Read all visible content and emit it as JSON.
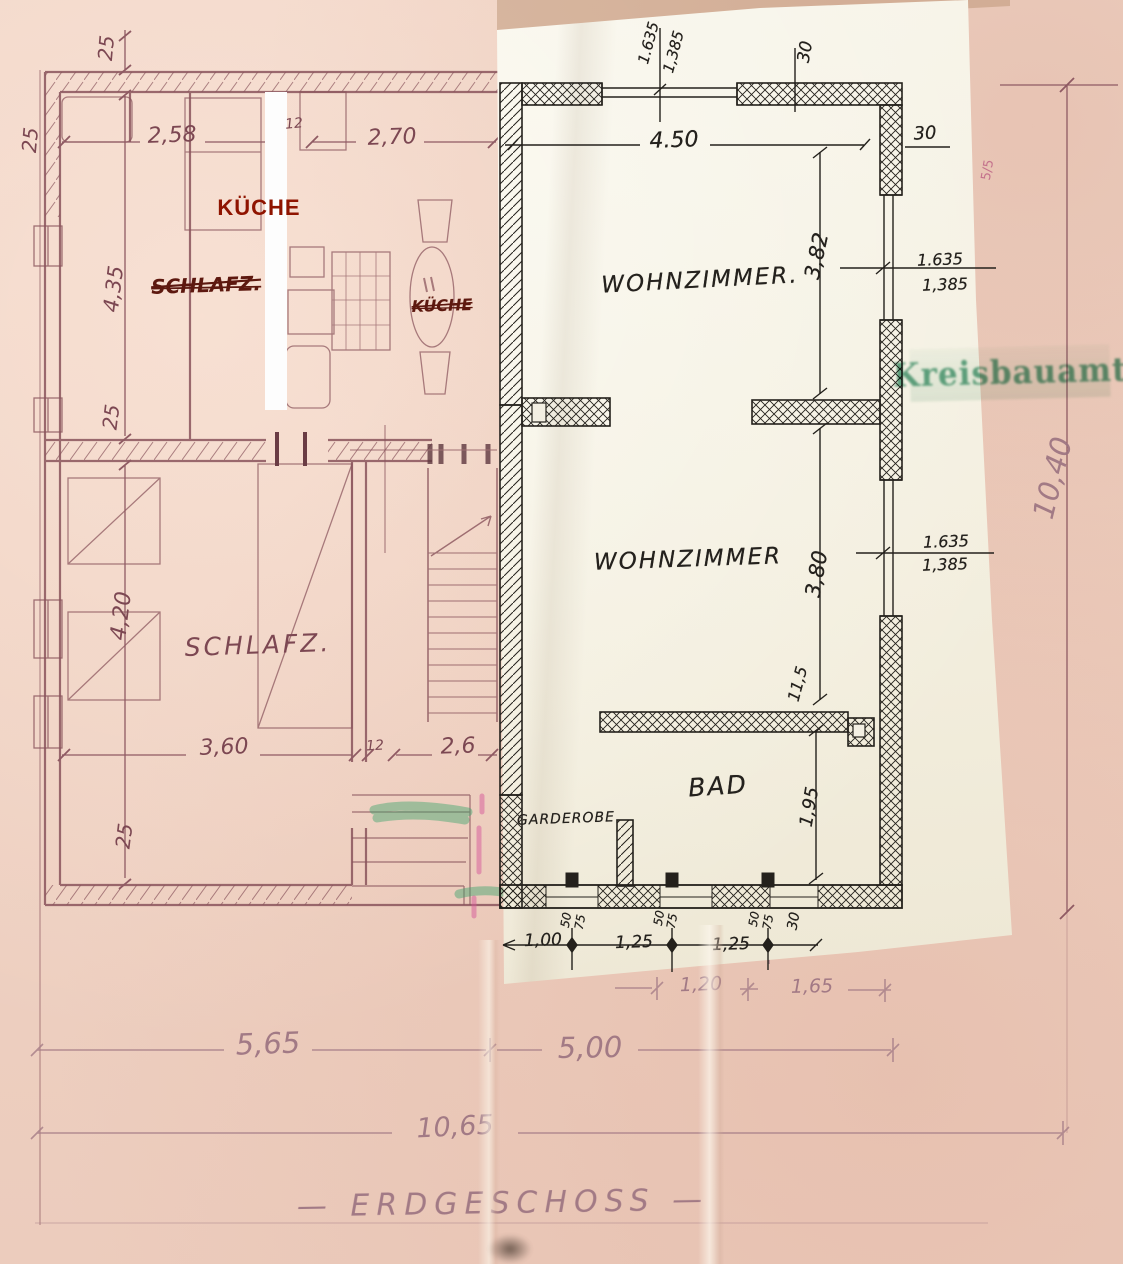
{
  "sheet": {
    "title": "ERDGESCHOSS",
    "title_display": "— ERDGESCHOSS —"
  },
  "stamp": {
    "text": "Kreisbauamt",
    "color": "#37906a"
  },
  "annotations": {
    "kueche_label": "KÜCHE"
  },
  "old_plan": {
    "rooms": [
      "SCHLAFZ.",
      "SCHLAFZ.",
      "KÜCHE"
    ],
    "labels": [
      {
        "name": "dim-25-top",
        "text": "25",
        "x": 106,
        "y": 48,
        "rot": -85,
        "fs": 20,
        "cls": "ink"
      },
      {
        "name": "dim-25-left",
        "text": "25",
        "x": 30,
        "y": 140,
        "rot": -85,
        "fs": 20,
        "cls": "ink"
      },
      {
        "name": "dim-2-58",
        "text": "2,58",
        "x": 172,
        "y": 136,
        "rot": -2,
        "fs": 22,
        "cls": "ink"
      },
      {
        "name": "dim-12-top",
        "text": "12",
        "x": 294,
        "y": 124,
        "rot": -5,
        "fs": 14,
        "cls": "ink"
      },
      {
        "name": "dim-2-70",
        "text": "2,70",
        "x": 392,
        "y": 138,
        "rot": -2,
        "fs": 22,
        "cls": "ink"
      },
      {
        "name": "room-label-schlafz-struck",
        "text": "SCHLAFZ.",
        "x": 206,
        "y": 285,
        "rot": -2,
        "fs": 20,
        "cls": "red struck"
      },
      {
        "name": "room-label-kueche-struck",
        "text": "KÜCHE",
        "x": 442,
        "y": 306,
        "rot": -2,
        "fs": 16,
        "cls": "red struck"
      },
      {
        "name": "dim-4-35",
        "text": "4,35",
        "x": 114,
        "y": 289,
        "rot": -83,
        "fs": 21,
        "cls": "ink"
      },
      {
        "name": "dim-25-mid",
        "text": "25",
        "x": 111,
        "y": 417,
        "rot": -83,
        "fs": 20,
        "cls": "ink"
      },
      {
        "name": "dim-4-20",
        "text": "4,20",
        "x": 122,
        "y": 616,
        "rot": -83,
        "fs": 22,
        "cls": "ink"
      },
      {
        "name": "dim-25-bottom",
        "text": "25",
        "x": 124,
        "y": 836,
        "rot": -83,
        "fs": 20,
        "cls": "ink"
      },
      {
        "name": "room-label-schlafz",
        "text": "SCHLAFZ.",
        "x": 258,
        "y": 645,
        "rot": -2,
        "fs": 25,
        "ls": 3,
        "cls": "ink"
      },
      {
        "name": "dim-3-60",
        "text": "3,60",
        "x": 224,
        "y": 748,
        "rot": -2,
        "fs": 22,
        "cls": "ink"
      },
      {
        "name": "dim-12-bottom",
        "text": "12",
        "x": 375,
        "y": 746,
        "rot": -3,
        "fs": 14,
        "cls": "ink"
      },
      {
        "name": "dim-2-6",
        "text": "2,6",
        "x": 458,
        "y": 747,
        "rot": -2,
        "fs": 22,
        "cls": "ink"
      },
      {
        "name": "dim-5-65",
        "text": "5,65",
        "x": 268,
        "y": 1044,
        "rot": -2,
        "fs": 29,
        "cls": "pencil"
      },
      {
        "name": "dim-5-00",
        "text": "5,00",
        "x": 590,
        "y": 1048,
        "rot": -1,
        "fs": 29,
        "cls": "pencil"
      },
      {
        "name": "dim-10-65",
        "text": "10,65",
        "x": 455,
        "y": 1127,
        "rot": -3,
        "fs": 27,
        "cls": "pencil"
      },
      {
        "name": "dim-1-20",
        "text": "1,20",
        "x": 701,
        "y": 985,
        "rot": -2,
        "fs": 19,
        "cls": "pencil"
      },
      {
        "name": "dim-1-65",
        "text": "1,65",
        "x": 812,
        "y": 987,
        "rot": -1,
        "fs": 19,
        "cls": "pencil"
      },
      {
        "name": "dim-10-40",
        "text": "10,40",
        "x": 1053,
        "y": 478,
        "rot": -76,
        "fs": 29,
        "cls": "pencil"
      },
      {
        "name": "mark-5-5",
        "text": "5/5",
        "x": 988,
        "y": 170,
        "rot": -80,
        "fs": 13,
        "cls": "pink"
      }
    ]
  },
  "overlay_plan": {
    "rooms": [
      "WOHNZIMMER.",
      "WOHNZIMMER",
      "BAD",
      "GARDEROBE"
    ],
    "labels": [
      {
        "name": "dim-1-635-top",
        "text": "1.635",
        "x": 649,
        "y": 43,
        "rot": -75,
        "fs": 15,
        "cls": "hand"
      },
      {
        "name": "dim-1-385-top",
        "text": "1,385",
        "x": 674,
        "y": 52,
        "rot": -75,
        "fs": 15,
        "cls": "hand"
      },
      {
        "name": "dim-30-top",
        "text": "30",
        "x": 806,
        "y": 52,
        "rot": -80,
        "fs": 17,
        "cls": "hand"
      },
      {
        "name": "dim-4-50",
        "text": "4.50",
        "x": 674,
        "y": 141,
        "rot": -2,
        "fs": 22,
        "cls": "hand"
      },
      {
        "name": "dim-30-corner",
        "text": "30",
        "x": 925,
        "y": 134,
        "rot": -3,
        "fs": 18,
        "cls": "hand"
      },
      {
        "name": "room-label-wohnzimmer-1",
        "text": "WOHNZIMMER.",
        "x": 700,
        "y": 281,
        "rot": -3,
        "fs": 23,
        "ls": 2,
        "cls": "hand"
      },
      {
        "name": "dim-3-82",
        "text": "3,82",
        "x": 817,
        "y": 256,
        "rot": -78,
        "fs": 21,
        "cls": "hand"
      },
      {
        "name": "dim-1-635-r1",
        "text": "1.635",
        "x": 940,
        "y": 260,
        "rot": -2,
        "fs": 16,
        "cls": "hand"
      },
      {
        "name": "dim-1-385-r1",
        "text": "1,385",
        "x": 945,
        "y": 285,
        "rot": -2,
        "fs": 16,
        "cls": "hand"
      },
      {
        "name": "room-label-wohnzimmer-2",
        "text": "WOHNZIMMER",
        "x": 688,
        "y": 560,
        "rot": -2,
        "fs": 23,
        "ls": 2,
        "cls": "hand"
      },
      {
        "name": "dim-3-80",
        "text": "3,80",
        "x": 817,
        "y": 574,
        "rot": -80,
        "fs": 21,
        "cls": "hand"
      },
      {
        "name": "dim-1-635-r2",
        "text": "1.635",
        "x": 946,
        "y": 542,
        "rot": -2,
        "fs": 16,
        "cls": "hand"
      },
      {
        "name": "dim-1-385-r2",
        "text": "1,385",
        "x": 945,
        "y": 565,
        "rot": -2,
        "fs": 16,
        "cls": "hand"
      },
      {
        "name": "dim-11-5",
        "text": "11,5",
        "x": 798,
        "y": 684,
        "rot": -75,
        "fs": 16,
        "cls": "hand"
      },
      {
        "name": "room-label-bad",
        "text": "BAD",
        "x": 718,
        "y": 786,
        "rot": -4,
        "fs": 25,
        "ls": 2,
        "cls": "hand"
      },
      {
        "name": "dim-1-95",
        "text": "1,95",
        "x": 810,
        "y": 807,
        "rot": -80,
        "fs": 18,
        "cls": "hand"
      },
      {
        "name": "room-label-garderobe",
        "text": "GARDEROBE",
        "x": 566,
        "y": 819,
        "rot": -2,
        "fs": 14,
        "ls": 1,
        "cls": "hand"
      },
      {
        "name": "dim-1-00",
        "text": "1,00",
        "x": 543,
        "y": 941,
        "rot": -2,
        "fs": 17,
        "cls": "hand"
      },
      {
        "name": "dim-50-a",
        "text": "50",
        "x": 566,
        "y": 920,
        "rot": -80,
        "fs": 12,
        "cls": "hand"
      },
      {
        "name": "dim-75-a",
        "text": "75",
        "x": 580,
        "y": 922,
        "rot": -80,
        "fs": 12,
        "cls": "hand"
      },
      {
        "name": "dim-1-25-a",
        "text": "1,25",
        "x": 634,
        "y": 943,
        "rot": -2,
        "fs": 17,
        "cls": "hand"
      },
      {
        "name": "dim-50-b",
        "text": "50",
        "x": 659,
        "y": 918,
        "rot": -80,
        "fs": 12,
        "cls": "hand"
      },
      {
        "name": "dim-75-b",
        "text": "75",
        "x": 672,
        "y": 921,
        "rot": -80,
        "fs": 12,
        "cls": "hand"
      },
      {
        "name": "dim-1-25-b",
        "text": "1,25",
        "x": 731,
        "y": 945,
        "rot": -2,
        "fs": 17,
        "cls": "hand"
      },
      {
        "name": "dim-50-c",
        "text": "50",
        "x": 754,
        "y": 919,
        "rot": -80,
        "fs": 12,
        "cls": "hand"
      },
      {
        "name": "dim-75-c",
        "text": "75",
        "x": 768,
        "y": 922,
        "rot": -80,
        "fs": 12,
        "cls": "hand"
      },
      {
        "name": "dim-30-bottom",
        "text": "30",
        "x": 794,
        "y": 921,
        "rot": -80,
        "fs": 14,
        "cls": "hand"
      }
    ]
  }
}
